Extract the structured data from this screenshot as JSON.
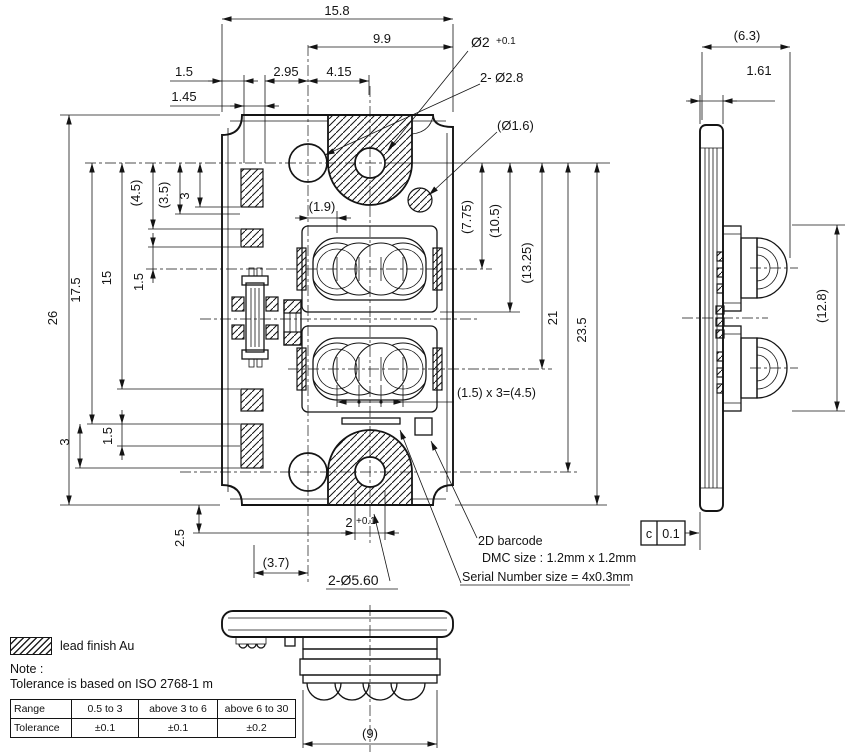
{
  "front_view": {
    "dim_top_overall": "15.8",
    "dim_top_right_span": "9.9",
    "dim_top_1_5": "1.5",
    "dim_top_2_95": "2.95",
    "dim_top_4_15": "4.15",
    "dim_top_1_45": "1.45",
    "callout_hole_dia": "Ø2",
    "callout_hole_dia_tol": "+0.1",
    "callout_holes_2_8": "2- Ø2.8",
    "callout_hole_1_6": "(Ø1.6)",
    "dim_left_26": "26",
    "dim_left_17_5": "17.5",
    "dim_left_15": "15",
    "dim_left_4_5": "(4.5)",
    "dim_left_3_5": "(3.5)",
    "dim_left_3_top": "3",
    "dim_left_1_5_top": "1.5",
    "dim_left_1_5_bot": "1.5",
    "dim_left_3_bot": "3",
    "dim_left_2_5": "2.5",
    "dim_inner_1_9": "(1.9)",
    "dim_right_7_75": "(7.75)",
    "dim_right_10_5": "(10.5)",
    "dim_right_13_25": "(13.25)",
    "dim_right_21": "21",
    "dim_right_23_5": "23.5",
    "dim_pit": "(1.5) x 3=(4.5)",
    "dim_bot_2": "2",
    "dim_bot_2_tol": "+0.1",
    "dim_bot_3_7": "(3.7)",
    "callout_lug_dia": "2-Ø5.60",
    "callout_barcode": "2D barcode",
    "callout_dmc": "DMC size : 1.2mm x 1.2mm",
    "callout_serial": "Serial Number size = 4x0.3mm"
  },
  "side_view": {
    "dim_width": "(6.3)",
    "dim_plate": "1.61",
    "dim_height": "(12.8)",
    "datum_letter": "c",
    "datum_value": "0.1"
  },
  "bottom_view": {
    "dim_width": "(9)"
  },
  "legend": {
    "label": "lead finish Au"
  },
  "note": {
    "title": "Note :",
    "text": "Tolerance is based on ISO 2768-1 m"
  },
  "tolerance_table": {
    "rows": [
      {
        "label": "Range",
        "c1": "0.5 to 3",
        "c2": "above 3 to 6",
        "c3": "above 6 to 30"
      },
      {
        "label": "Tolerance",
        "c1": "±0.1",
        "c2": "±0.1",
        "c3": "±0.2"
      }
    ]
  }
}
